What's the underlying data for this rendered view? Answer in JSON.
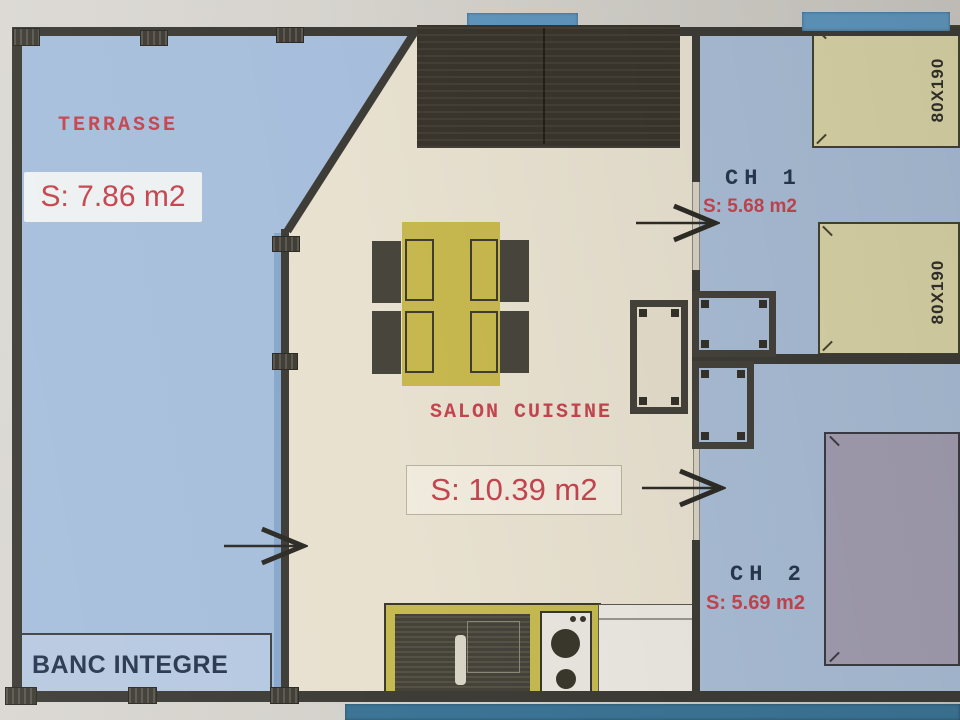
{
  "rooms": {
    "terrasse": {
      "name": "TERRASSE",
      "area": "S: 7.86 m2"
    },
    "salon_cuisine": {
      "name": "SALON CUISINE",
      "area": "S: 10.39 m2"
    },
    "chambre_1": {
      "name": "CH 1",
      "area": "S: 5.68 m2"
    },
    "chambre_2": {
      "name": "CH 2",
      "area": "S: 5.69 m2"
    }
  },
  "furniture": {
    "bench": "BANC INTEGRE",
    "bed_1_size": "80X190",
    "bed_2_size": "80X190"
  },
  "colors": {
    "terrace_fill": "#a7bfdc",
    "bedroom_fill": "#a9bdd5",
    "salon_fill": "#e8e1d0",
    "wall": "#3e3c36",
    "label_red": "#c4454f",
    "label_navy": "#28374f",
    "table_yellow": "#c7b84e",
    "kitchen_yellow": "#c5ba50",
    "bed_cream": "#d9d3a6",
    "bed_gray": "#a29eb0",
    "window_blue": "#6096bd"
  }
}
